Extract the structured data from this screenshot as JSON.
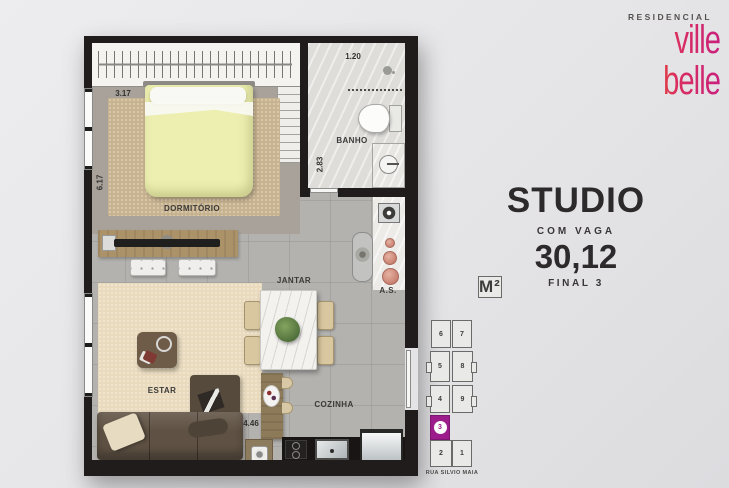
{
  "logo": {
    "residencial": "RESIDENCIAL",
    "word1": "ville",
    "word2": "belle",
    "gradient_from": "#e85a10",
    "gradient_to": "#c9207c"
  },
  "title": {
    "name": "STUDIO",
    "vaga": "COM VAGA",
    "area_value": "30,12",
    "area_unit": "M²",
    "final": "FINAL 3"
  },
  "floorplan": {
    "labels": {
      "dormitorio": "DORMITÓRIO",
      "banho": "BANHO",
      "jantar": "JANTAR",
      "estar": "ESTAR",
      "cozinha": "COZINHA",
      "area_servico": "A.S."
    },
    "dimensions": {
      "dorm_width": "3.17",
      "left_height": "6.17",
      "banho_width": "1.20",
      "banho_height": "2.83",
      "cozinha_width": "4.46"
    },
    "wall_color": "#201c1b"
  },
  "keyplan": {
    "street": "RUA SILVIO MAIA",
    "highlight_color": "#9c1c8c",
    "units": [
      {
        "label": "6",
        "highlighted": false
      },
      {
        "label": "7",
        "highlighted": false
      },
      {
        "label": "5",
        "highlighted": false
      },
      {
        "label": "8",
        "highlighted": false
      },
      {
        "label": "4",
        "highlighted": false
      },
      {
        "label": "9",
        "highlighted": false
      },
      {
        "label": "3",
        "highlighted": true
      },
      {
        "label": "2",
        "highlighted": false
      },
      {
        "label": "1",
        "highlighted": false
      }
    ]
  }
}
